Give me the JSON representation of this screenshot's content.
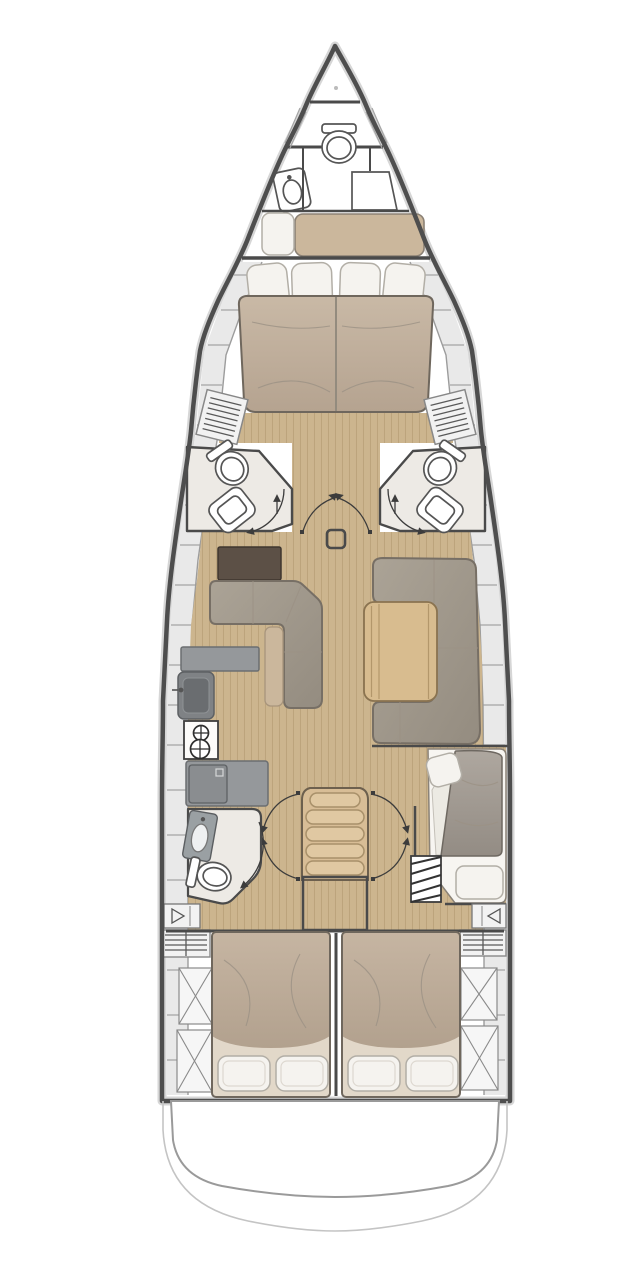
{
  "diagram": {
    "type": "yacht-interior-deck-plan",
    "view": "top-down",
    "orientation": "bow-up"
  },
  "palette": {
    "hull_outline": "#4e4e4e",
    "hull_halo": "#d6d6d6",
    "deck_band": "#e9e9e9",
    "deck_line": "#a5a5a5",
    "wall_line": "#4a4a4a",
    "wood_floor": "#ccb58e",
    "wood_plank_line": "#b59c74",
    "mattress": "#c1b19f",
    "sheet": "#e2d8c9",
    "pillow": "#f5f3ef",
    "pillow_line": "#b2aea6",
    "bench": "#cbb79c",
    "sofa": "#a39b8f",
    "sofa_line": "#776f65",
    "table_wood": "#d8bc8f",
    "dark_cabinet": "#5c5046",
    "counter": "#95989b",
    "counter_line": "#6b6e71",
    "head_floor": "#edeae5",
    "fixture_line": "#555555",
    "arc_line": "#3c3c3c",
    "steps": "#d8bd96"
  },
  "vessel": {
    "rooms": [
      {
        "id": "anchor-locker",
        "name": "Anchor locker",
        "fixtures": []
      },
      {
        "id": "crew-cabin",
        "name": "Bow crew cabin",
        "fixtures": [
          "toilet",
          "washbasin",
          "storage-locker",
          "bench-berth",
          "pillow"
        ]
      },
      {
        "id": "forward-cabin",
        "name": "Forward double cabin",
        "fixtures": [
          "double-berth",
          "four-pillows",
          "hanging-locker-port",
          "hanging-locker-starboard"
        ]
      },
      {
        "id": "forward-head-port",
        "name": "Forward en-suite head (port)",
        "fixtures": [
          "toilet",
          "shower-seat",
          "door-swing"
        ]
      },
      {
        "id": "forward-head-starboard",
        "name": "Forward en-suite head (starboard)",
        "fixtures": [
          "toilet",
          "shower-seat",
          "door-swing"
        ]
      },
      {
        "id": "saloon",
        "name": "Saloon",
        "fixtures": [
          "l-sofa-port",
          "sideboard-cabinet",
          "u-sofa-starboard",
          "dining-table",
          "mast-step"
        ]
      },
      {
        "id": "galley",
        "name": "Galley (port)",
        "fixtures": [
          "counter",
          "sink",
          "two-burner-stove",
          "refrigerator"
        ]
      },
      {
        "id": "companionway",
        "name": "Companionway",
        "fixtures": [
          "five-steps",
          "landing"
        ]
      },
      {
        "id": "aft-head-port",
        "name": "Aft head (port)",
        "fixtures": [
          "washbasin",
          "toilet",
          "door-swing"
        ]
      },
      {
        "id": "starboard-aft-cabin",
        "name": "Starboard aft cabin",
        "fixtures": [
          "offset-berth",
          "two-pillows",
          "entry-steps"
        ]
      },
      {
        "id": "aft-cabin-port",
        "name": "Aft double cabin (port)",
        "fixtures": [
          "double-berth",
          "two-pillows"
        ]
      },
      {
        "id": "aft-cabin-starboard",
        "name": "Aft double cabin (starboard)",
        "fixtures": [
          "double-berth",
          "two-pillows"
        ]
      },
      {
        "id": "stern-platform",
        "name": "Stern / swim platform",
        "fixtures": []
      }
    ],
    "deck_features": [
      "side-deck-locker-segments",
      "louvered-vents",
      "x-hatch-lockers",
      "door-swing-arcs",
      "technical-lockers"
    ]
  }
}
